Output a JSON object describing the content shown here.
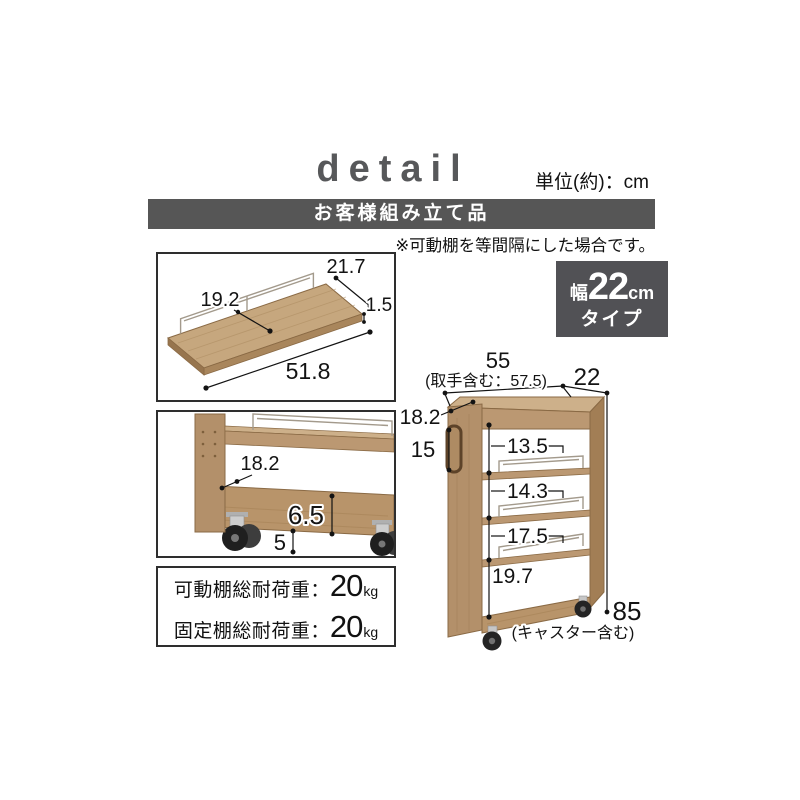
{
  "header": {
    "title": "detail",
    "unit_label": "単位(約)：cm"
  },
  "banner": {
    "text": "お客様組み立て品"
  },
  "note": "※可動棚を等間隔にした場合です。",
  "width_badge": {
    "prefix": "幅",
    "value": "22",
    "unit": "cm",
    "suffix": "タイプ"
  },
  "shelf_box": {
    "top_width": "21.7",
    "inner_width": "19.2",
    "thickness": "1.5",
    "length": "51.8"
  },
  "detail_box": {
    "shelf_depth": "18.2",
    "base_height": "6.5",
    "clearance": "5"
  },
  "load_box": {
    "rows": [
      {
        "label": "可動棚総耐荷重：",
        "value": "20",
        "unit": "kg"
      },
      {
        "label": "固定棚総耐荷重：",
        "value": "20",
        "unit": "kg"
      }
    ]
  },
  "cart": {
    "width": "55",
    "width_with_handle": "(取手含む：57.5)",
    "depth": "22",
    "top_shelf_depth": "18.2",
    "handle_height": "15",
    "shelf_gap_1": "13.5",
    "shelf_gap_2": "14.3",
    "shelf_gap_3": "17.5",
    "shelf_gap_4": "19.7",
    "total_height": "85",
    "total_height_note": "(キャスター含む)"
  }
}
